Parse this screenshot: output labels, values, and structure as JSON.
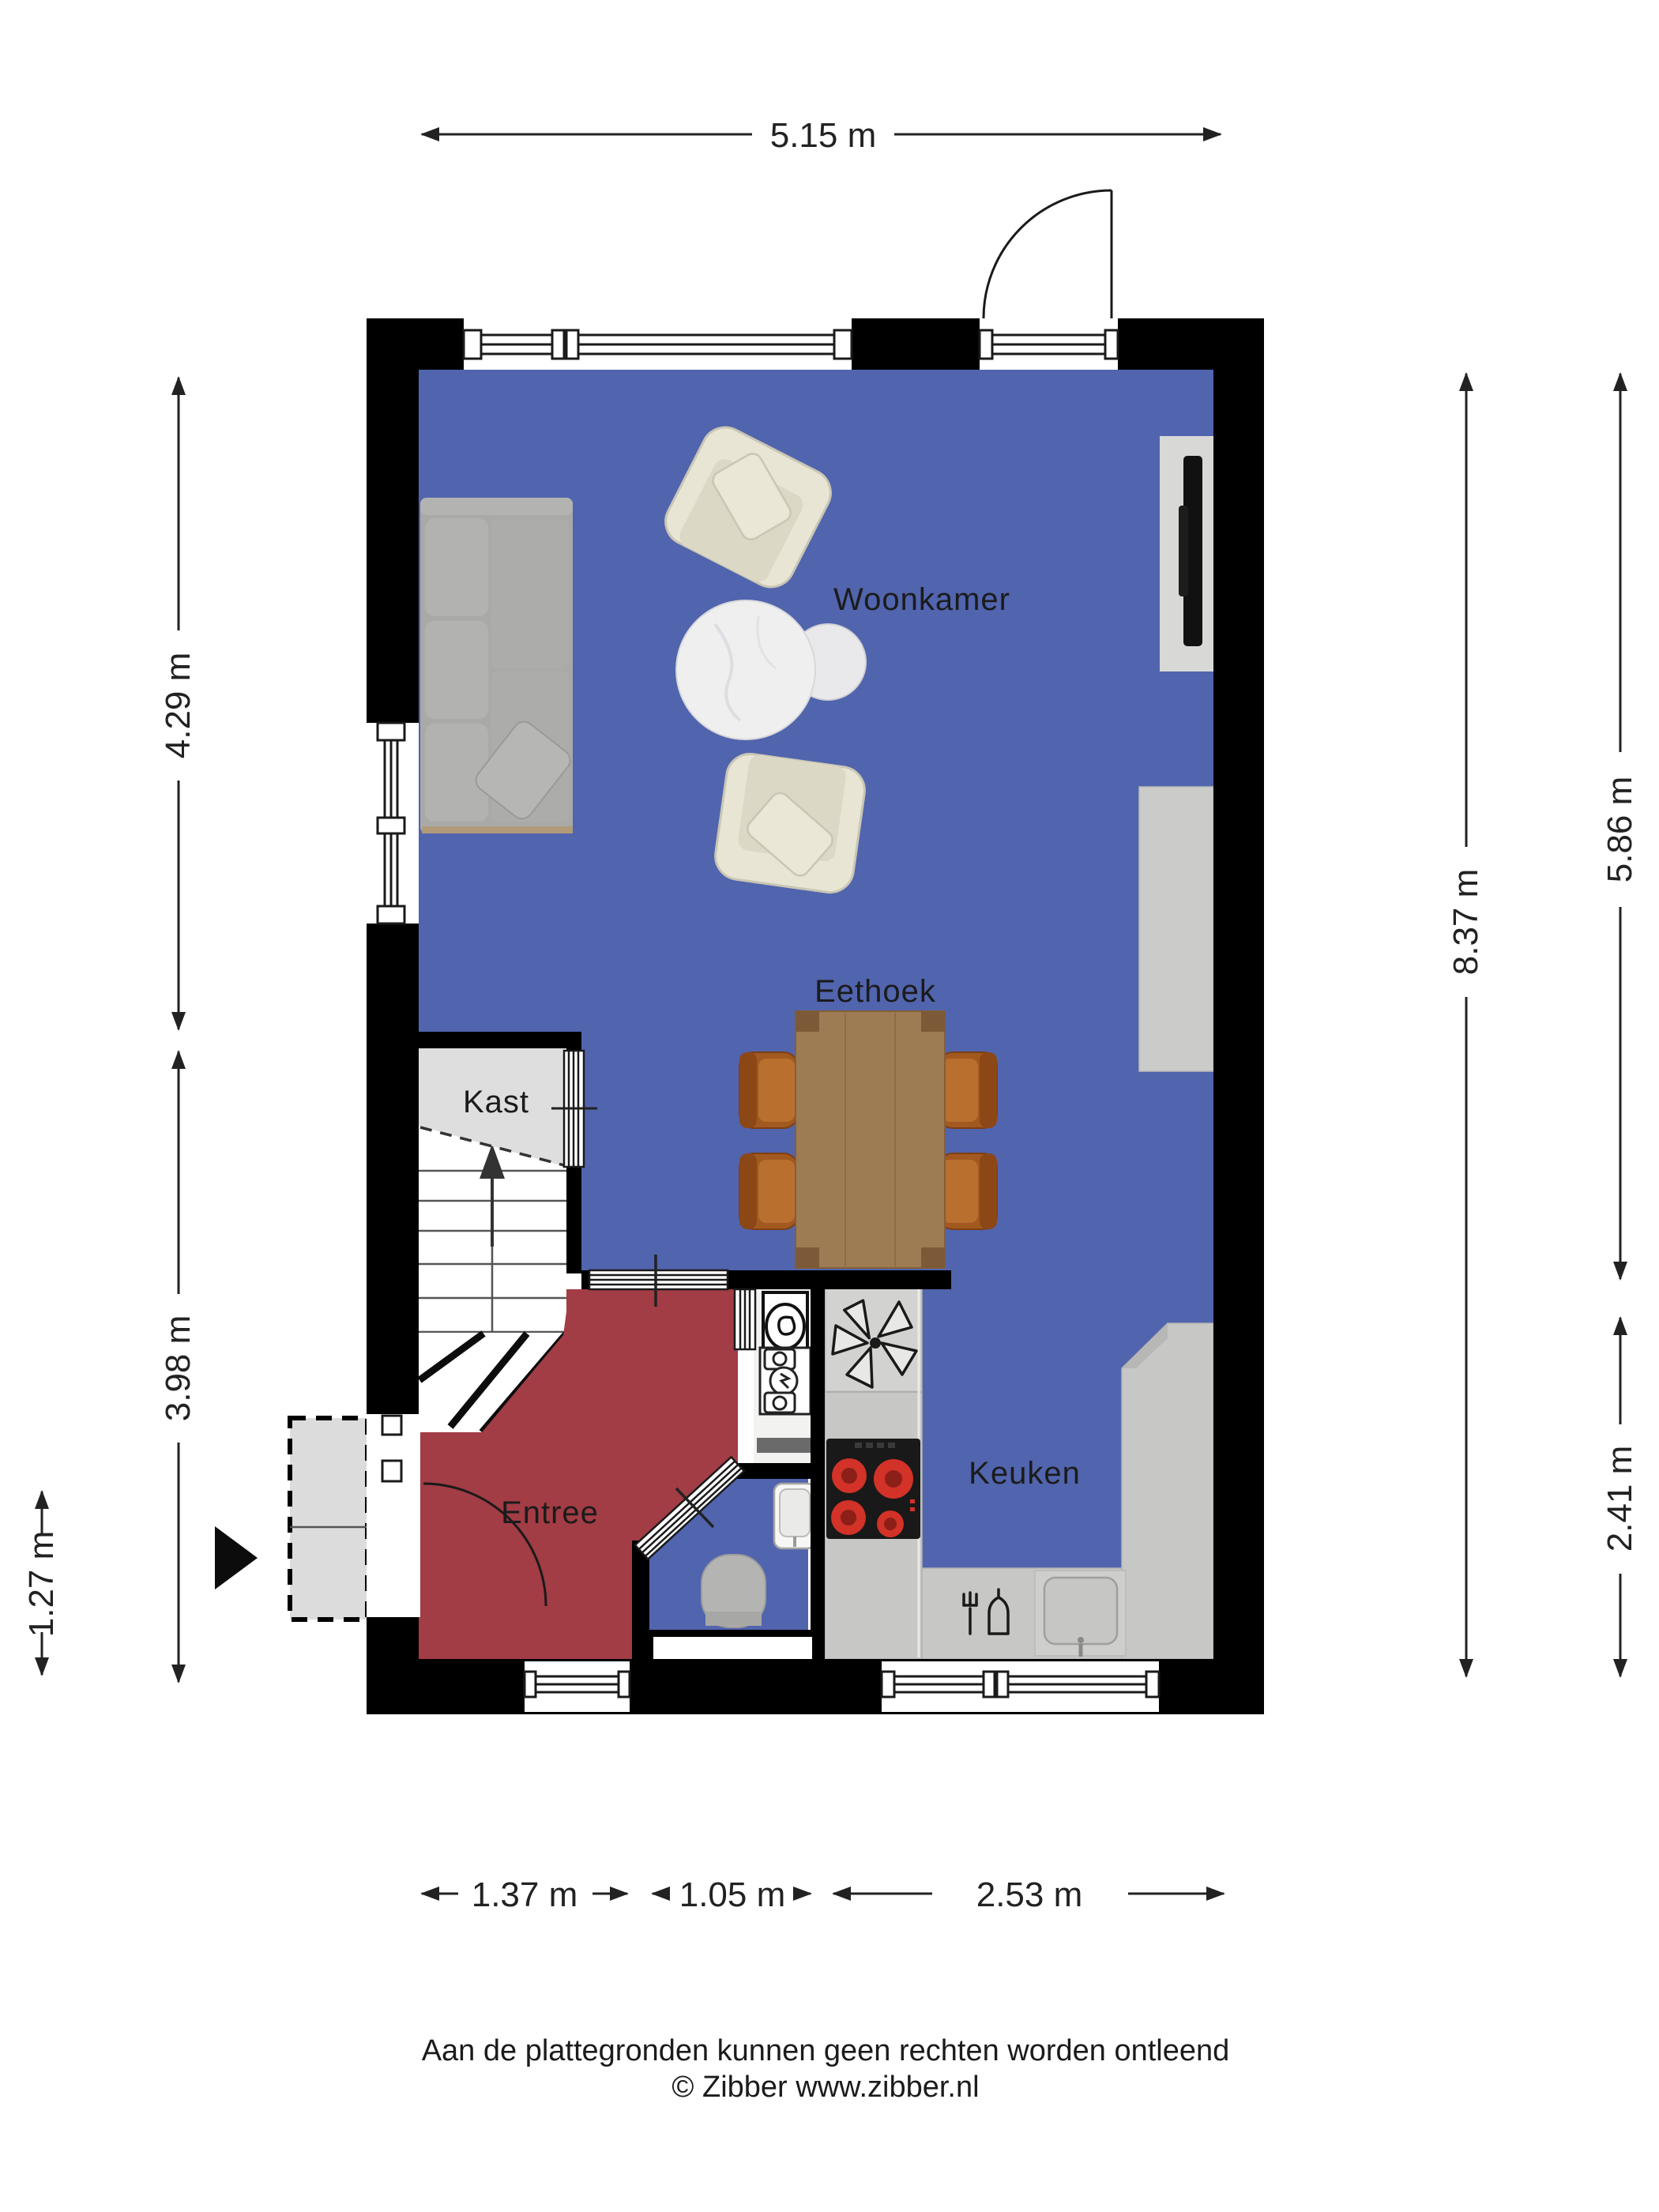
{
  "rooms": {
    "woonkamer": "Woonkamer",
    "eethoek": "Eethoek",
    "kast": "Kast",
    "entree": "Entree",
    "keuken": "Keuken"
  },
  "dimensions": {
    "top": "5.15 m",
    "left_upper": "4.29 m",
    "left_lower": "3.98 m",
    "left_inner": "1.27 m",
    "right_outer": "8.37 m",
    "right_upper": "5.86 m",
    "right_lower": "2.41 m",
    "bottom_left": "1.37 m",
    "bottom_middle": "1.05 m",
    "bottom_right": "2.53 m"
  },
  "footer": {
    "disclaimer": "Aan de plattegronden kunnen geen rechten worden ontleend",
    "copyright": "© Zibber www.zibber.nl"
  },
  "colors": {
    "wall": "#000000",
    "floor_main": "#5164ae",
    "floor_entree": "#a23c45",
    "floor_kast": "#dedede",
    "counter": "#c7c7c5",
    "dimension": "#222222",
    "sofa_gray": "#a9a9a7",
    "armchair_beige": "#e8e5d5",
    "table_wood": "#9d7c54",
    "chair_brown": "#a2591f",
    "burner_red": "#d23227"
  }
}
